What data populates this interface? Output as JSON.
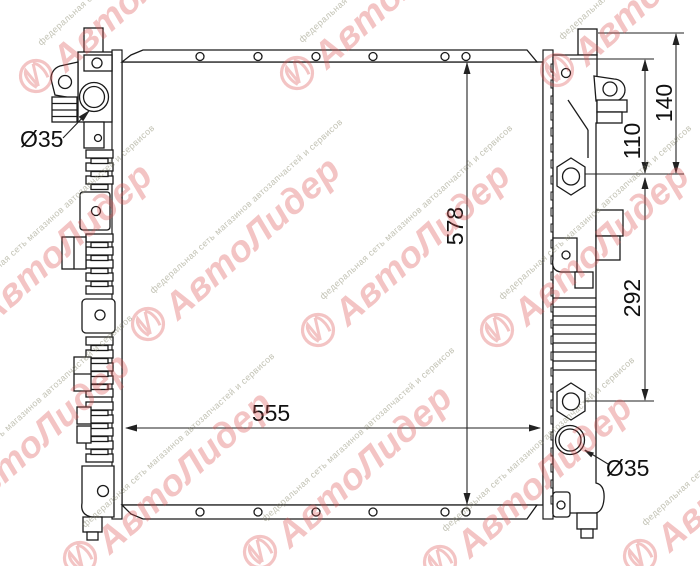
{
  "dimensions": {
    "core_height": "578",
    "core_width": "555",
    "upper_bracket_height": "140",
    "pin_to_bolt": "110",
    "bolt_span": "292",
    "inlet_diameter": "Ø35",
    "outlet_diameter": "Ø35"
  },
  "watermark": {
    "brand": "АвтоЛидер",
    "tagline": "федеральная сеть магазинов автозапчастей и сервисов",
    "brand_color": "rgba(221,83,83,0.34)",
    "tagline_color": "rgba(134,134,106,0.5)"
  }
}
